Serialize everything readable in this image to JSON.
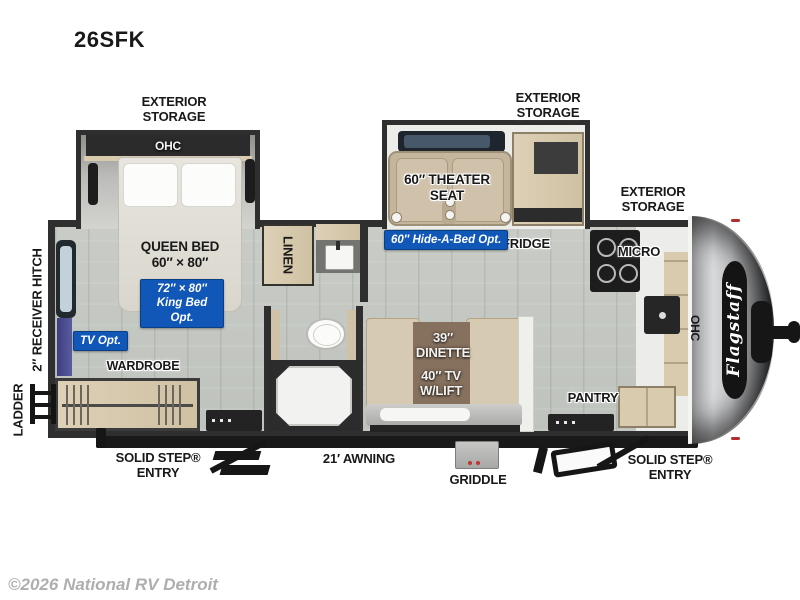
{
  "title": "26SFK",
  "watermark": "©2026 National RV Detroit",
  "brand": "Flagstaff",
  "labels": {
    "exterior_storage": "EXTERIOR\nSTORAGE",
    "ohc": "OHC",
    "queen_bed": "QUEEN BED\n60″ × 80″",
    "king_bed_opt": "72″ × 80″\nKing Bed Opt.",
    "tv_opt": "TV Opt.",
    "wardrobe": "WARDROBE",
    "ladder": "LADDER",
    "receiver_hitch": "2″ RECEIVER HITCH",
    "linen": "LINEN",
    "theater_seat": "60″ THEATER\nSEAT",
    "hide_a_bed_opt": "60″ Hide-A-Bed Opt.",
    "fridge": "FRIDGE",
    "micro": "MICRO",
    "dinette": "39″\nDINETTE",
    "tv_lift": "40″ TV\nW/LIFT",
    "pantry": "PANTRY",
    "solid_step_entry": "SOLID STEP®\nENTRY",
    "awning": "21′ AWNING",
    "griddle": "GRIDDLE"
  },
  "colors": {
    "badge_blue": "#1057b8",
    "wall_dark": "#2f2f2f",
    "floor_gray": "#c5c9c3",
    "cabinet_wood": "#d6c9ae",
    "front_cap_silver": "#c2c3c5"
  }
}
